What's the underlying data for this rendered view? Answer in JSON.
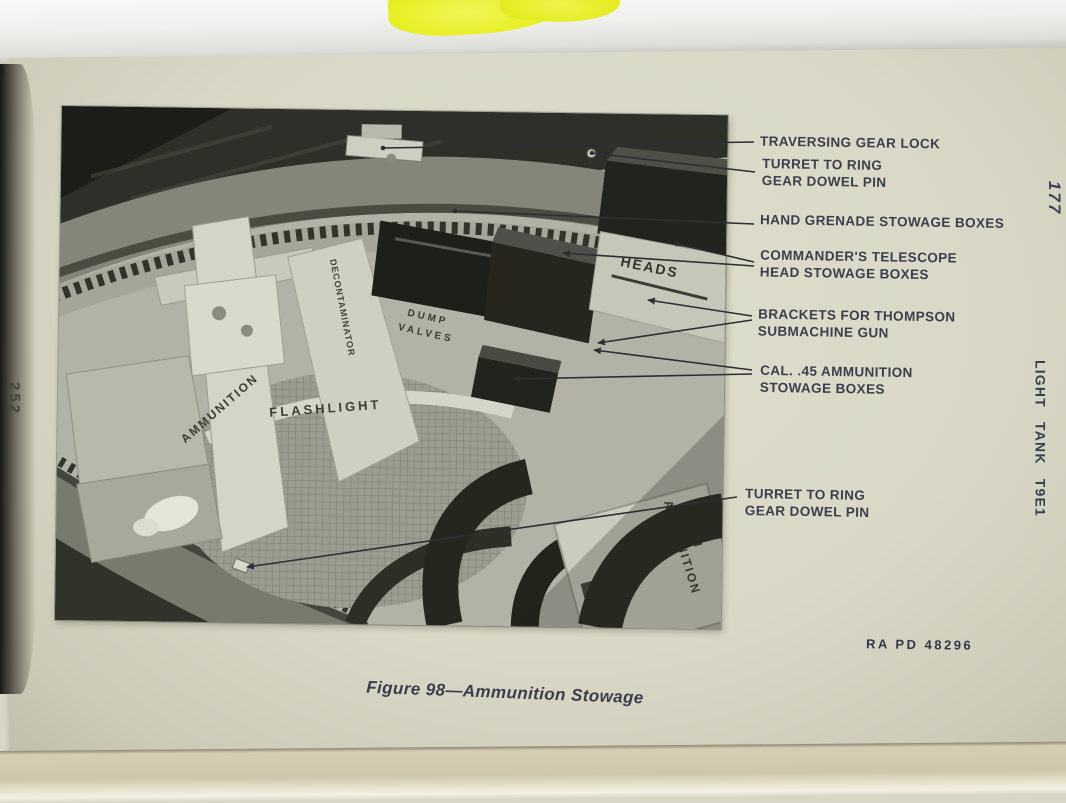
{
  "colors": {
    "paper": "#d9d8c6",
    "ink": "#3b3e4d",
    "highlighter": "#e3ee2b",
    "photo_gray": "#b2b2a6"
  },
  "page": {
    "left_page_number": "252",
    "right_edge_number": "177",
    "margin_title": "LIGHT TANK T9E1",
    "figure_caption": "Figure 98—Ammunition Stowage",
    "photo_credit": "RA PD 48296"
  },
  "callouts": [
    {
      "line1": "TRAVERSING GEAR LOCK",
      "line2": ""
    },
    {
      "line1": "TURRET TO RING",
      "line2": "GEAR DOWEL PIN"
    },
    {
      "line1": "HAND GRENADE STOWAGE BOXES",
      "line2": ""
    },
    {
      "line1": "COMMANDER'S TELESCOPE",
      "line2": "HEAD STOWAGE BOXES"
    },
    {
      "line1": "BRACKETS FOR THOMPSON",
      "line2": "SUBMACHINE GUN"
    },
    {
      "line1": "CAL. .45 AMMUNITION",
      "line2": "STOWAGE BOXES"
    },
    {
      "line1": "TURRET TO RING",
      "line2": "GEAR DOWEL PIN"
    }
  ],
  "photo": {
    "stencils": {
      "heads": "HEADS",
      "dump_valves_1": "DUMP",
      "dump_valves_2": "VALVES",
      "flashlight": "FLASHLIGHT",
      "ammunition": "AMMUNITION",
      "decontaminator": "DECONTAMINATOR",
      "ammo_37_1": "37 MM",
      "ammo_37_2": "AMMUNITION"
    }
  }
}
